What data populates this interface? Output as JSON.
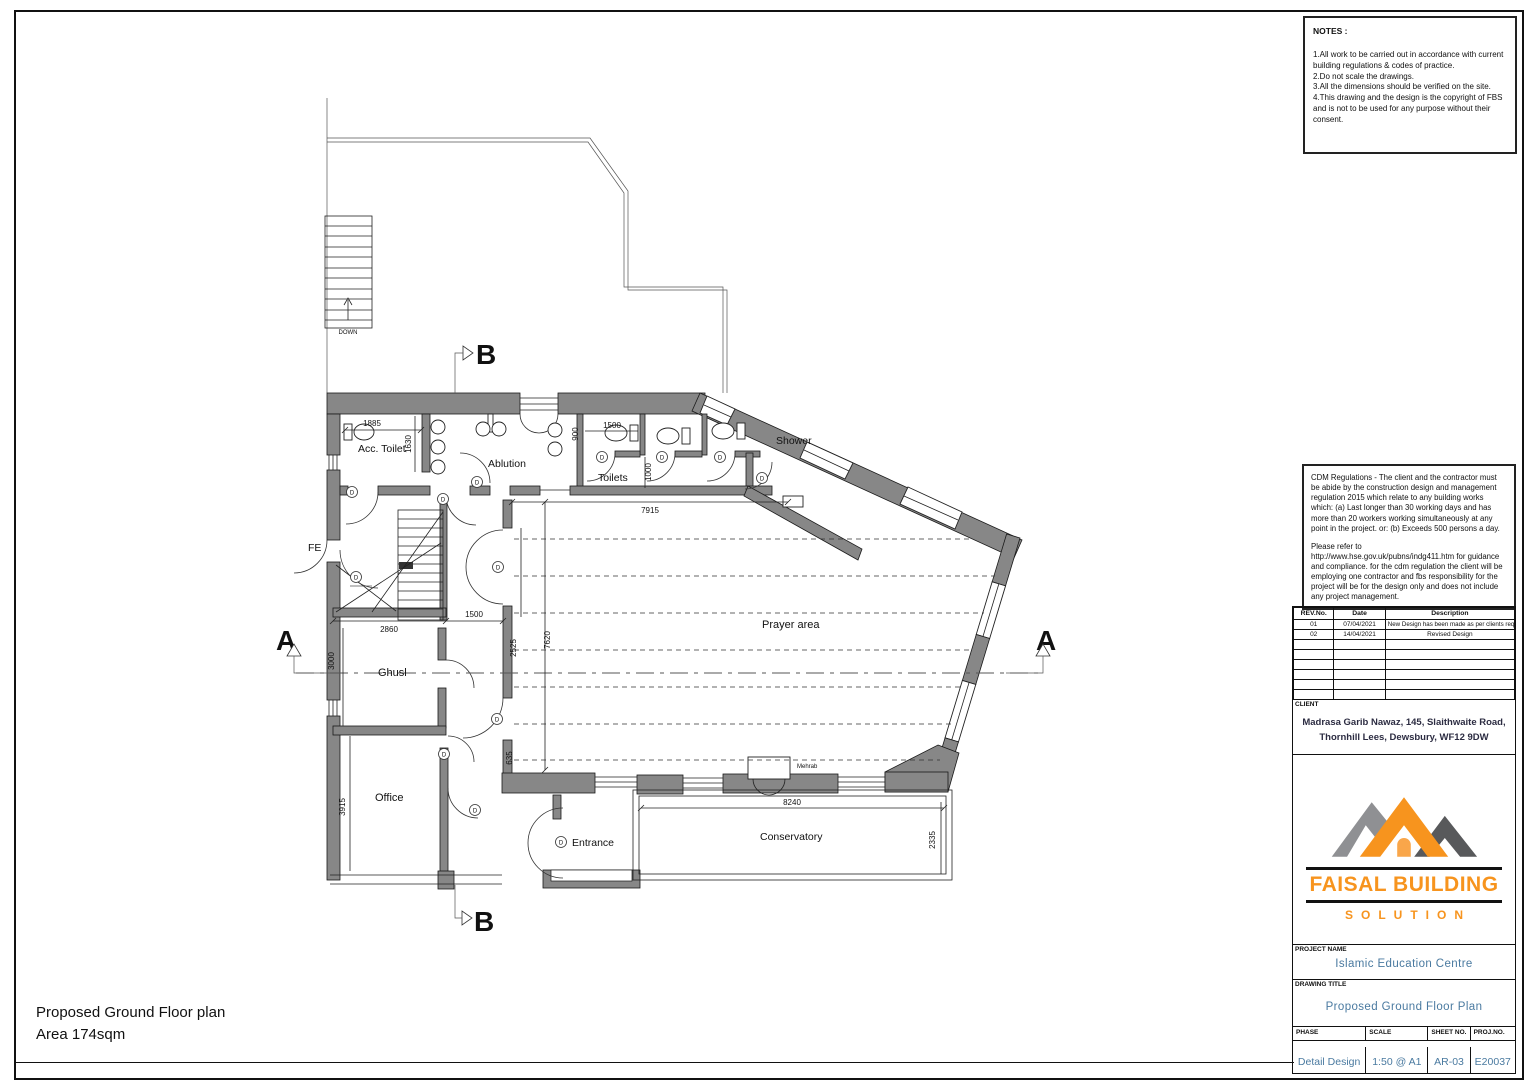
{
  "page": {
    "footer_title": "Proposed Ground Floor plan",
    "footer_area": "Area 174sqm"
  },
  "notes": {
    "title": "NOTES :",
    "body": "1.All work to be carried out in accordance with current\nbuilding regulations & codes of practice.\n2.Do not scale the drawings.\n3.All the dimensions should be verified on the site.\n4.This drawing and the design is the copyright of FBS\n  and is not to be used for any purpose without their\n  consent."
  },
  "cdm": {
    "para1": "CDM Regulations - The client and the contractor must be abide by the construction design and management regulation 2015 which relate to any building works which: (a) Last longer than 30 working days and has more than 20 workers working simultaneously at any point in the project.  or: (b) Exceeds 500 persons a day.",
    "para2": "Please refer to\nhttp://www.hse.gov.uk/pubns/indg411.htm for guidance and compliance. for the cdm regulation the client will be employing one contractor and fbs responsibility for the project will be for the design only and does not include any project management."
  },
  "revision_table": {
    "headers": [
      "REV.No.",
      "Date",
      "Description"
    ],
    "rows": [
      [
        "01",
        "07/04/2021",
        "New Design has been made as per clients requirement"
      ],
      [
        "02",
        "14/04/2021",
        "Revised Design"
      ]
    ]
  },
  "client": {
    "label": "CLIENT",
    "address1": "Madrasa Garib Nawaz, 145, Slaithwaite Road,",
    "address2": "Thornhill Lees, Dewsbury, WF12 9DW"
  },
  "logo": {
    "name": "FAISAL BUILDING",
    "subname": "SOLUTION",
    "orange": "#f7941e",
    "gray": "#8f9093",
    "dark_gray": "#58595b"
  },
  "title_block": {
    "project_label": "PROJECT NAME",
    "project_name": "Islamic Education Centre",
    "drawing_label": "DRAWING TITLE",
    "drawing_title": "Proposed Ground Floor Plan",
    "phase_label": "PHASE",
    "phase": "Detail Design",
    "scale_label": "SCALE",
    "scale": "1:50 @ A1",
    "sheet_label": "SHEET NO.",
    "sheet_no": "AR-03",
    "proj_label": "PROJ.NO.",
    "proj_no": "E20037",
    "value_color": "#4a7aa0"
  },
  "plan": {
    "labels": {
      "acc_toilet": "Acc. Toilet",
      "ablution": "Ablution",
      "toilets": "Toilets",
      "shower": "Shower",
      "prayer": "Prayer area",
      "ghusl": "Ghusl",
      "office": "Office",
      "entrance": "Entrance",
      "conservatory": "Conservatory",
      "fe": "FE",
      "mehrab": "Mehrab",
      "down": "DOWN"
    },
    "dims": {
      "d1885": "1885",
      "d1630": "1630",
      "d1500a": "1500",
      "d900": "900",
      "d1000": "1000",
      "d7915": "7915",
      "d2860": "2860",
      "d1500b": "1500",
      "d2525": "2525",
      "d7620": "7620",
      "d3000": "3000",
      "d635": "635",
      "d3915": "3915",
      "d8240": "8240",
      "d2335": "2335"
    },
    "sections": {
      "a": "A",
      "b": "B"
    },
    "door_tag": "D"
  }
}
